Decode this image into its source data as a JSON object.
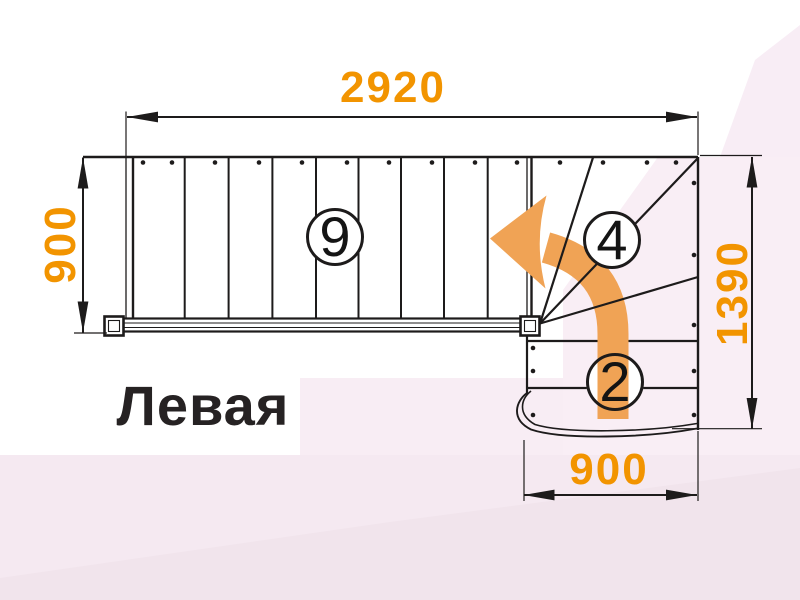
{
  "title": "Левая",
  "dimensions": {
    "top_width": "2920",
    "left_height": "900",
    "right_height": "1390",
    "bottom_width": "900"
  },
  "step_counts": {
    "straight_flight": "9",
    "winder_steps": "4",
    "bottom_flight": "2"
  },
  "colors": {
    "dimension_text": "#F29400",
    "direction_arrow": "#F0A355",
    "drawing_lines": "#1D1B1B",
    "background_tint": "#F5E9F1"
  }
}
